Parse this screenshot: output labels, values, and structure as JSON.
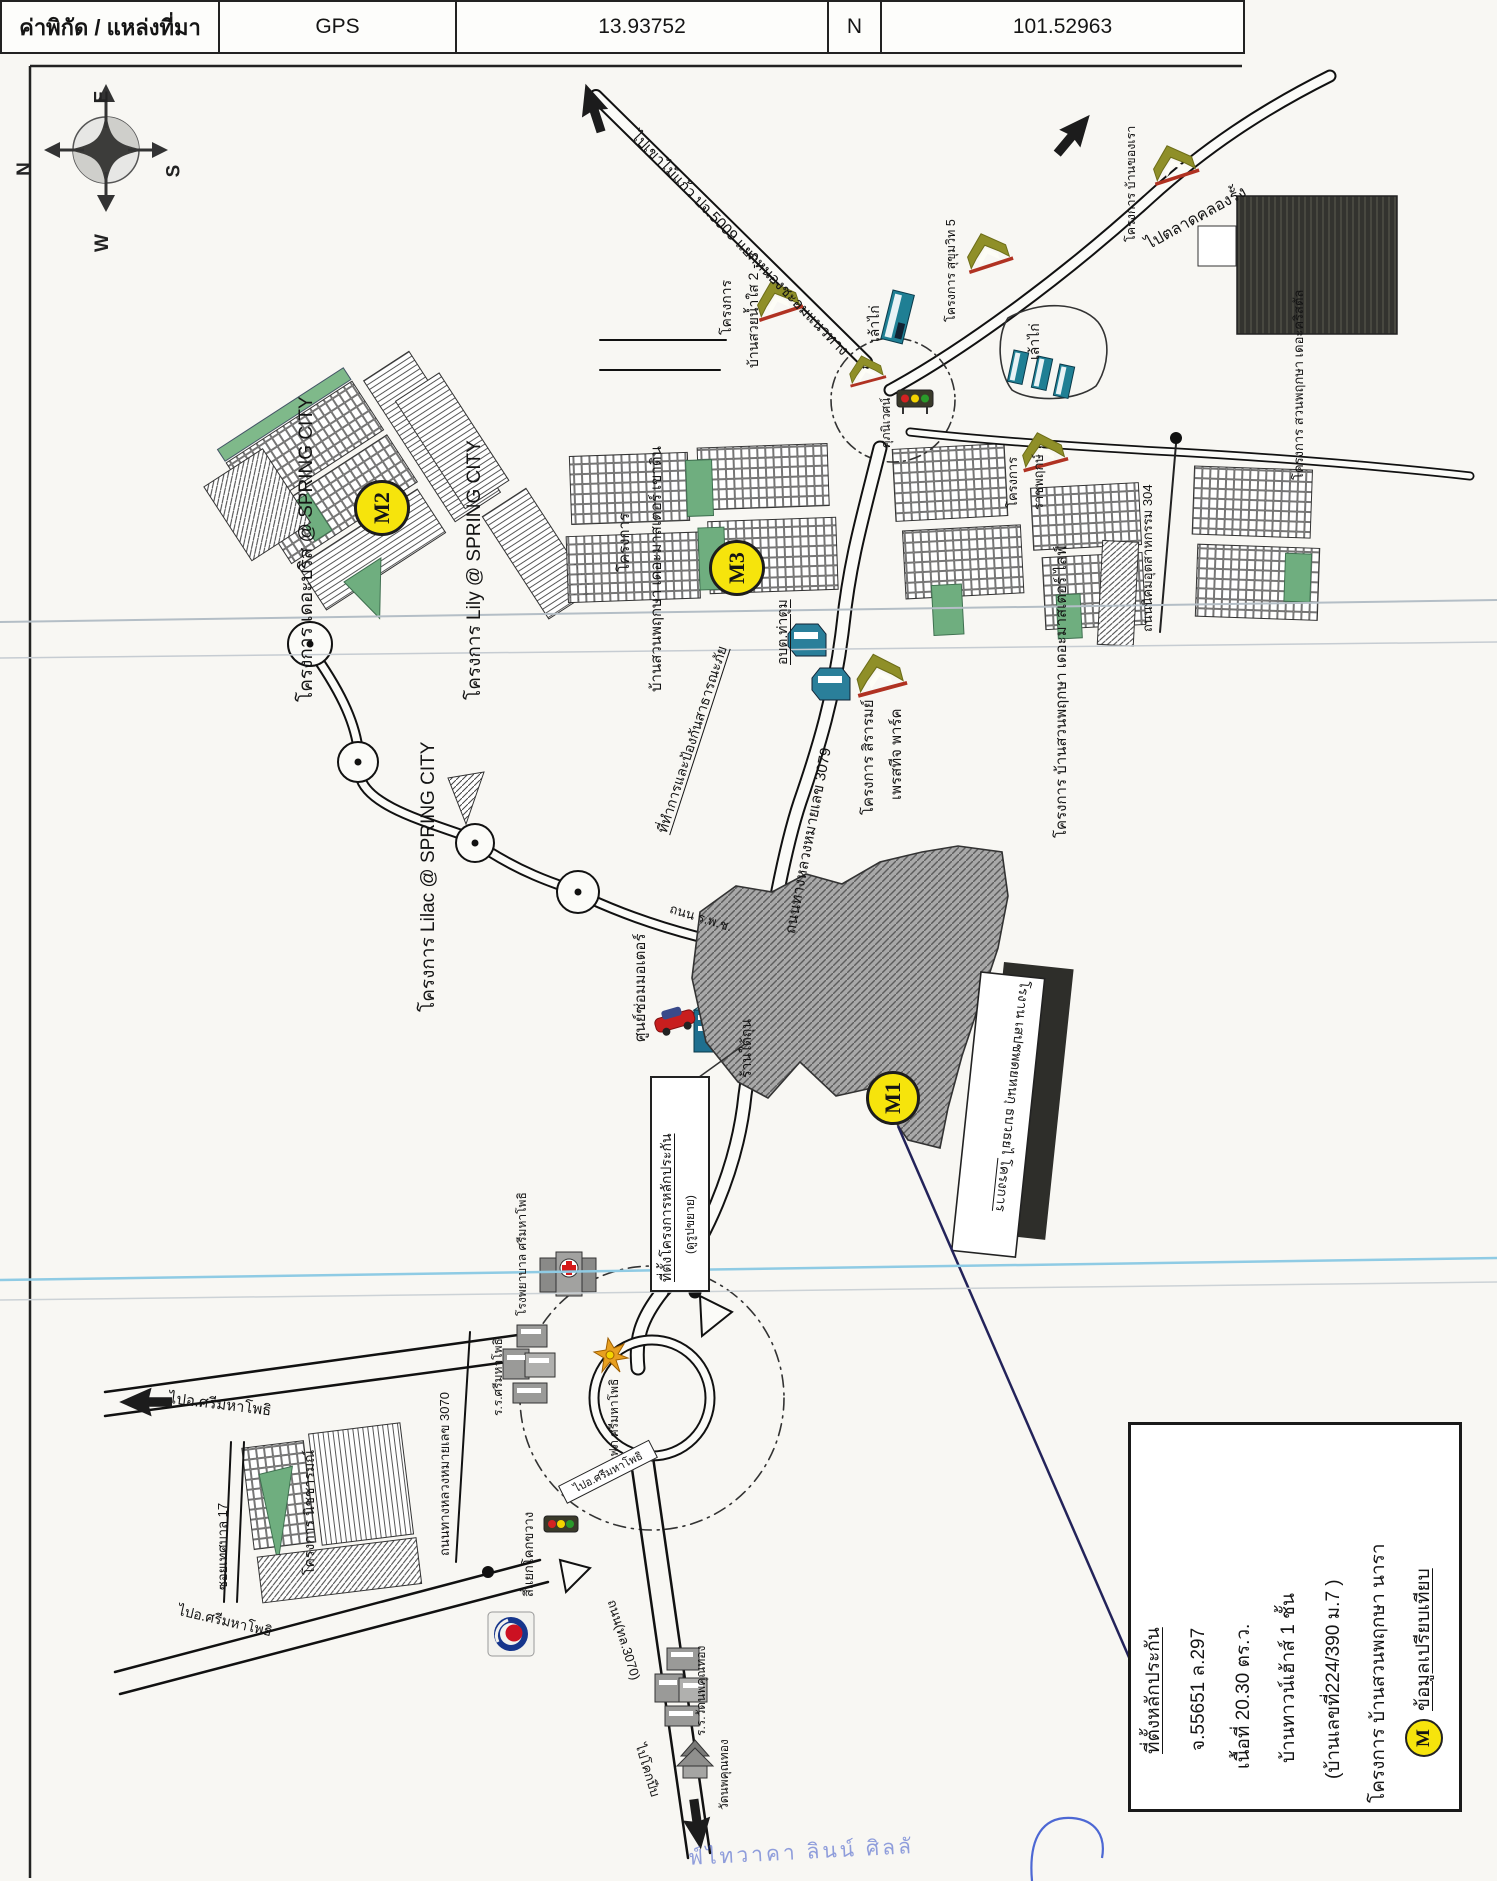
{
  "header": {
    "title": "ค่าพิกัด / แหล่งที่มา",
    "gps_label": "GPS",
    "latitude": "13.93752",
    "hemisphere": "N",
    "longitude": "101.52963"
  },
  "compass": {
    "n": "N",
    "e": "E",
    "s": "S",
    "w": "W"
  },
  "markers": {
    "m1": "M1",
    "m2": "M2",
    "m3": "M3",
    "m": "M"
  },
  "labels": {
    "road_5009": "ไปเขาไม้แก้ว ปจ.5009 แยกหนองชะอมแนวทาง",
    "baan_suay_1": "โครงการ",
    "baan_suay_2": "บ้านสวยน้ำใส 2 - 3",
    "chicken_1": "เล้าไก่",
    "chicken_2": "เล้าไก่",
    "sukhumvit5": "โครงการ สุขุมวิท 5",
    "baankhongrao": "โครงการ บ้านของเรา",
    "talad_khlongrang": "ไปตลาดคลองรั้ง",
    "crystal": "โครงการ สวนพฤกษา เดอะคริสตัล",
    "supaniwet": "ศุภนิเวศน์",
    "breeze": "โครงการ เดอะบริส @ SPRING CITY",
    "lily": "โครงการ Lily @ SPRING CITY",
    "lilac": "โครงการ Lilac @ SPRING CITY",
    "khaodin_1": "โครงการ",
    "khaodin_2": "บ้านสวนพฤกษา เดอะมาสเตอร์ เขาดิน",
    "disaster_office": "ที่ทำการและป้องกันสาธารณะภัย",
    "obt_thatum": "อบต.ท่าตูม",
    "sirarom_1": "โครงการ สิรารมย์",
    "sirarom_2": "เพรสทีจ พาร์ค",
    "ratchaphruek_1": "โครงการ",
    "ratchaphruek_2": "ราชพฤกษ์",
    "masterlife": "โครงการ บ้านสวนพฤกษา เดอะมาสเตอร์ ไลฟ์",
    "road_304": "ถนนนิคมอุตสาหกรรม 304",
    "road_3079": "ถนนทางหลวงหมายเลข 3079",
    "road_rpc": "ถนน ร.พ.ช.",
    "motor_shop": "ศูนย์ซ่อมมอเตอร์",
    "shop_taithun": "ร้านใต้ถุน",
    "sitebox_1": "ที่ตั้งโครงการหลักประกัน",
    "sitebox_2": "(ดูรูปขยาย)",
    "factory_1": "โรงาน เสปชพดยหนกุ ธบวธยไ",
    "factory_2": "โครงการ",
    "soi_17": "ซอยเทศบาล 17",
    "nitcharom": "โครงการ นิชชารมณ์",
    "road_3070": "ถนนทางหลวงหมายเลข 3070",
    "school_sri": "ร.ร.ศรีมหาโพธิ",
    "hospital_sri": "โรงพยาบาล ศรีมหาโพธิ",
    "pea_sri": "กฟภ.ศรีมหาโพธิ",
    "khokkwang": "สี่แยกโคกขวาง",
    "sign_sri": "ไปอ.ศรีมหาโพธิ",
    "to_sri_w": "ไปอ.ศรีมหาโพธิ",
    "to_sri_sw": "ไปอ.ศรีมหาโพธิ",
    "road_3070b": "ถนน(ทล.3070)",
    "to_khokpip": "ไปโคกปีบ",
    "school_wat": "ร.ร.วัดนพคุณทอง",
    "wat_noppakhun": "วัดนพคุณทอง"
  },
  "legend": {
    "lines": [
      "ที่ตั้งหลักประกัน",
      "จ.55651 ล.297",
      "เนื้อที่ 20.30 ตร.ว.",
      "บ้านทาวน์เฮ้าส์ 1 ชั้น",
      "(บ้านเลขที่224/390 ม.7 )",
      "โครงการ บ้านสวนพฤกษา นารา",
      "ข้อมูลเปรียบเทียบ"
    ],
    "marker": "M"
  },
  "stamp": {
    "text": "ฟ์ไทวาคา ลินน์ ศิลลั"
  }
}
